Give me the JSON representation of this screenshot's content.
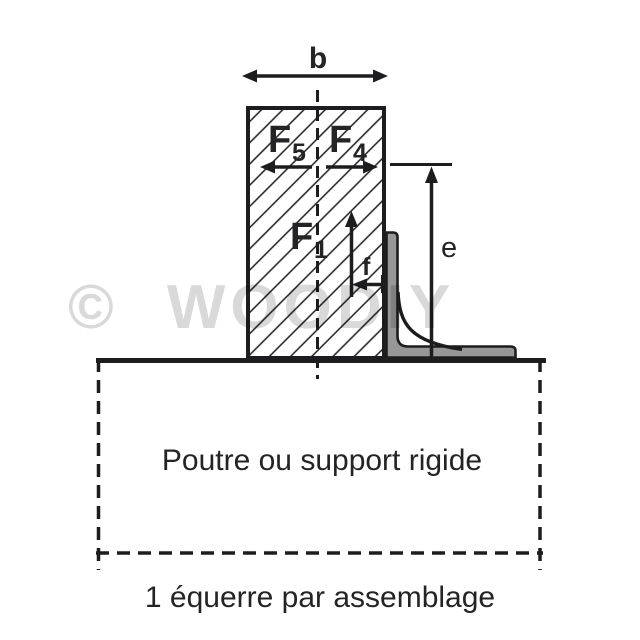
{
  "watermark": {
    "text": "© WOODIY",
    "color": "#d9d9d9"
  },
  "diagram": {
    "labels": {
      "width_dim": "b",
      "force_left_main": "F",
      "force_left_sub": "5",
      "force_right_main": "F",
      "force_right_sub": "4",
      "force_axial_main": "F",
      "force_axial_sub": "1",
      "offset_dim": "f",
      "height_dim": "e"
    },
    "support_label": "Poutre ou support rigide",
    "caption": "1 équerre par assemblage",
    "colors": {
      "line": "#1d1d1f",
      "bracket_fill": "#979797",
      "text": "#242426",
      "watermark": "#d9d9d9"
    }
  }
}
